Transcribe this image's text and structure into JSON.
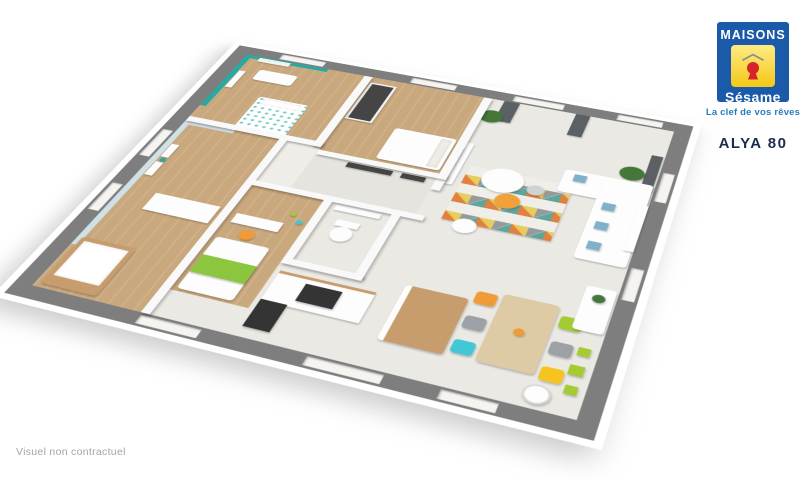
{
  "brand": {
    "logo_top": "MAISONS",
    "logo_bottom": "Sésame",
    "tagline": "La clef de vos rêves",
    "model_name": "ALYA 80",
    "colors": {
      "blue": "#1a5aa8",
      "yellow": "#f5c916",
      "red": "#d8232a",
      "roof_gray": "#8a8a8a",
      "tagline_blue": "#2a7cc0",
      "model_navy": "#1c2b50"
    }
  },
  "footer": {
    "disclaimer": "Visuel non contractuel"
  },
  "floorplan": {
    "colors": {
      "outer_wall": "#7e7e7e",
      "inner_wall": "#f9f9f9",
      "slab_white": "#ffffff",
      "wood_floor": "#c9a87e",
      "tile_floor": "#ebe9e4",
      "hall_tile": "#e6e4df",
      "teal_accent": "#2aa9a1",
      "lightblue_accent": "#cfe1e7",
      "curtain_gray": "#5a6064",
      "plant_green": "#45763a",
      "tv_black": "#1e1e1e",
      "dark_furniture": "#454545",
      "appliance_dark": "#343434",
      "wood_furniture": "#c79d6d",
      "table_wood": "#decba6",
      "white_furniture": "#fdfdfd",
      "chair_orange": "#f09a38",
      "chair_green": "#a4cb33",
      "chair_cyan": "#43c7d4",
      "chair_yellow": "#f6c41e",
      "chair_gray": "#9ba1a4",
      "bed_green": "#8cc63e",
      "pillow_blue": "#7fb2c9",
      "side_table_orange": "#f0a13a",
      "side_table_gray": "#cfd2d4"
    }
  }
}
